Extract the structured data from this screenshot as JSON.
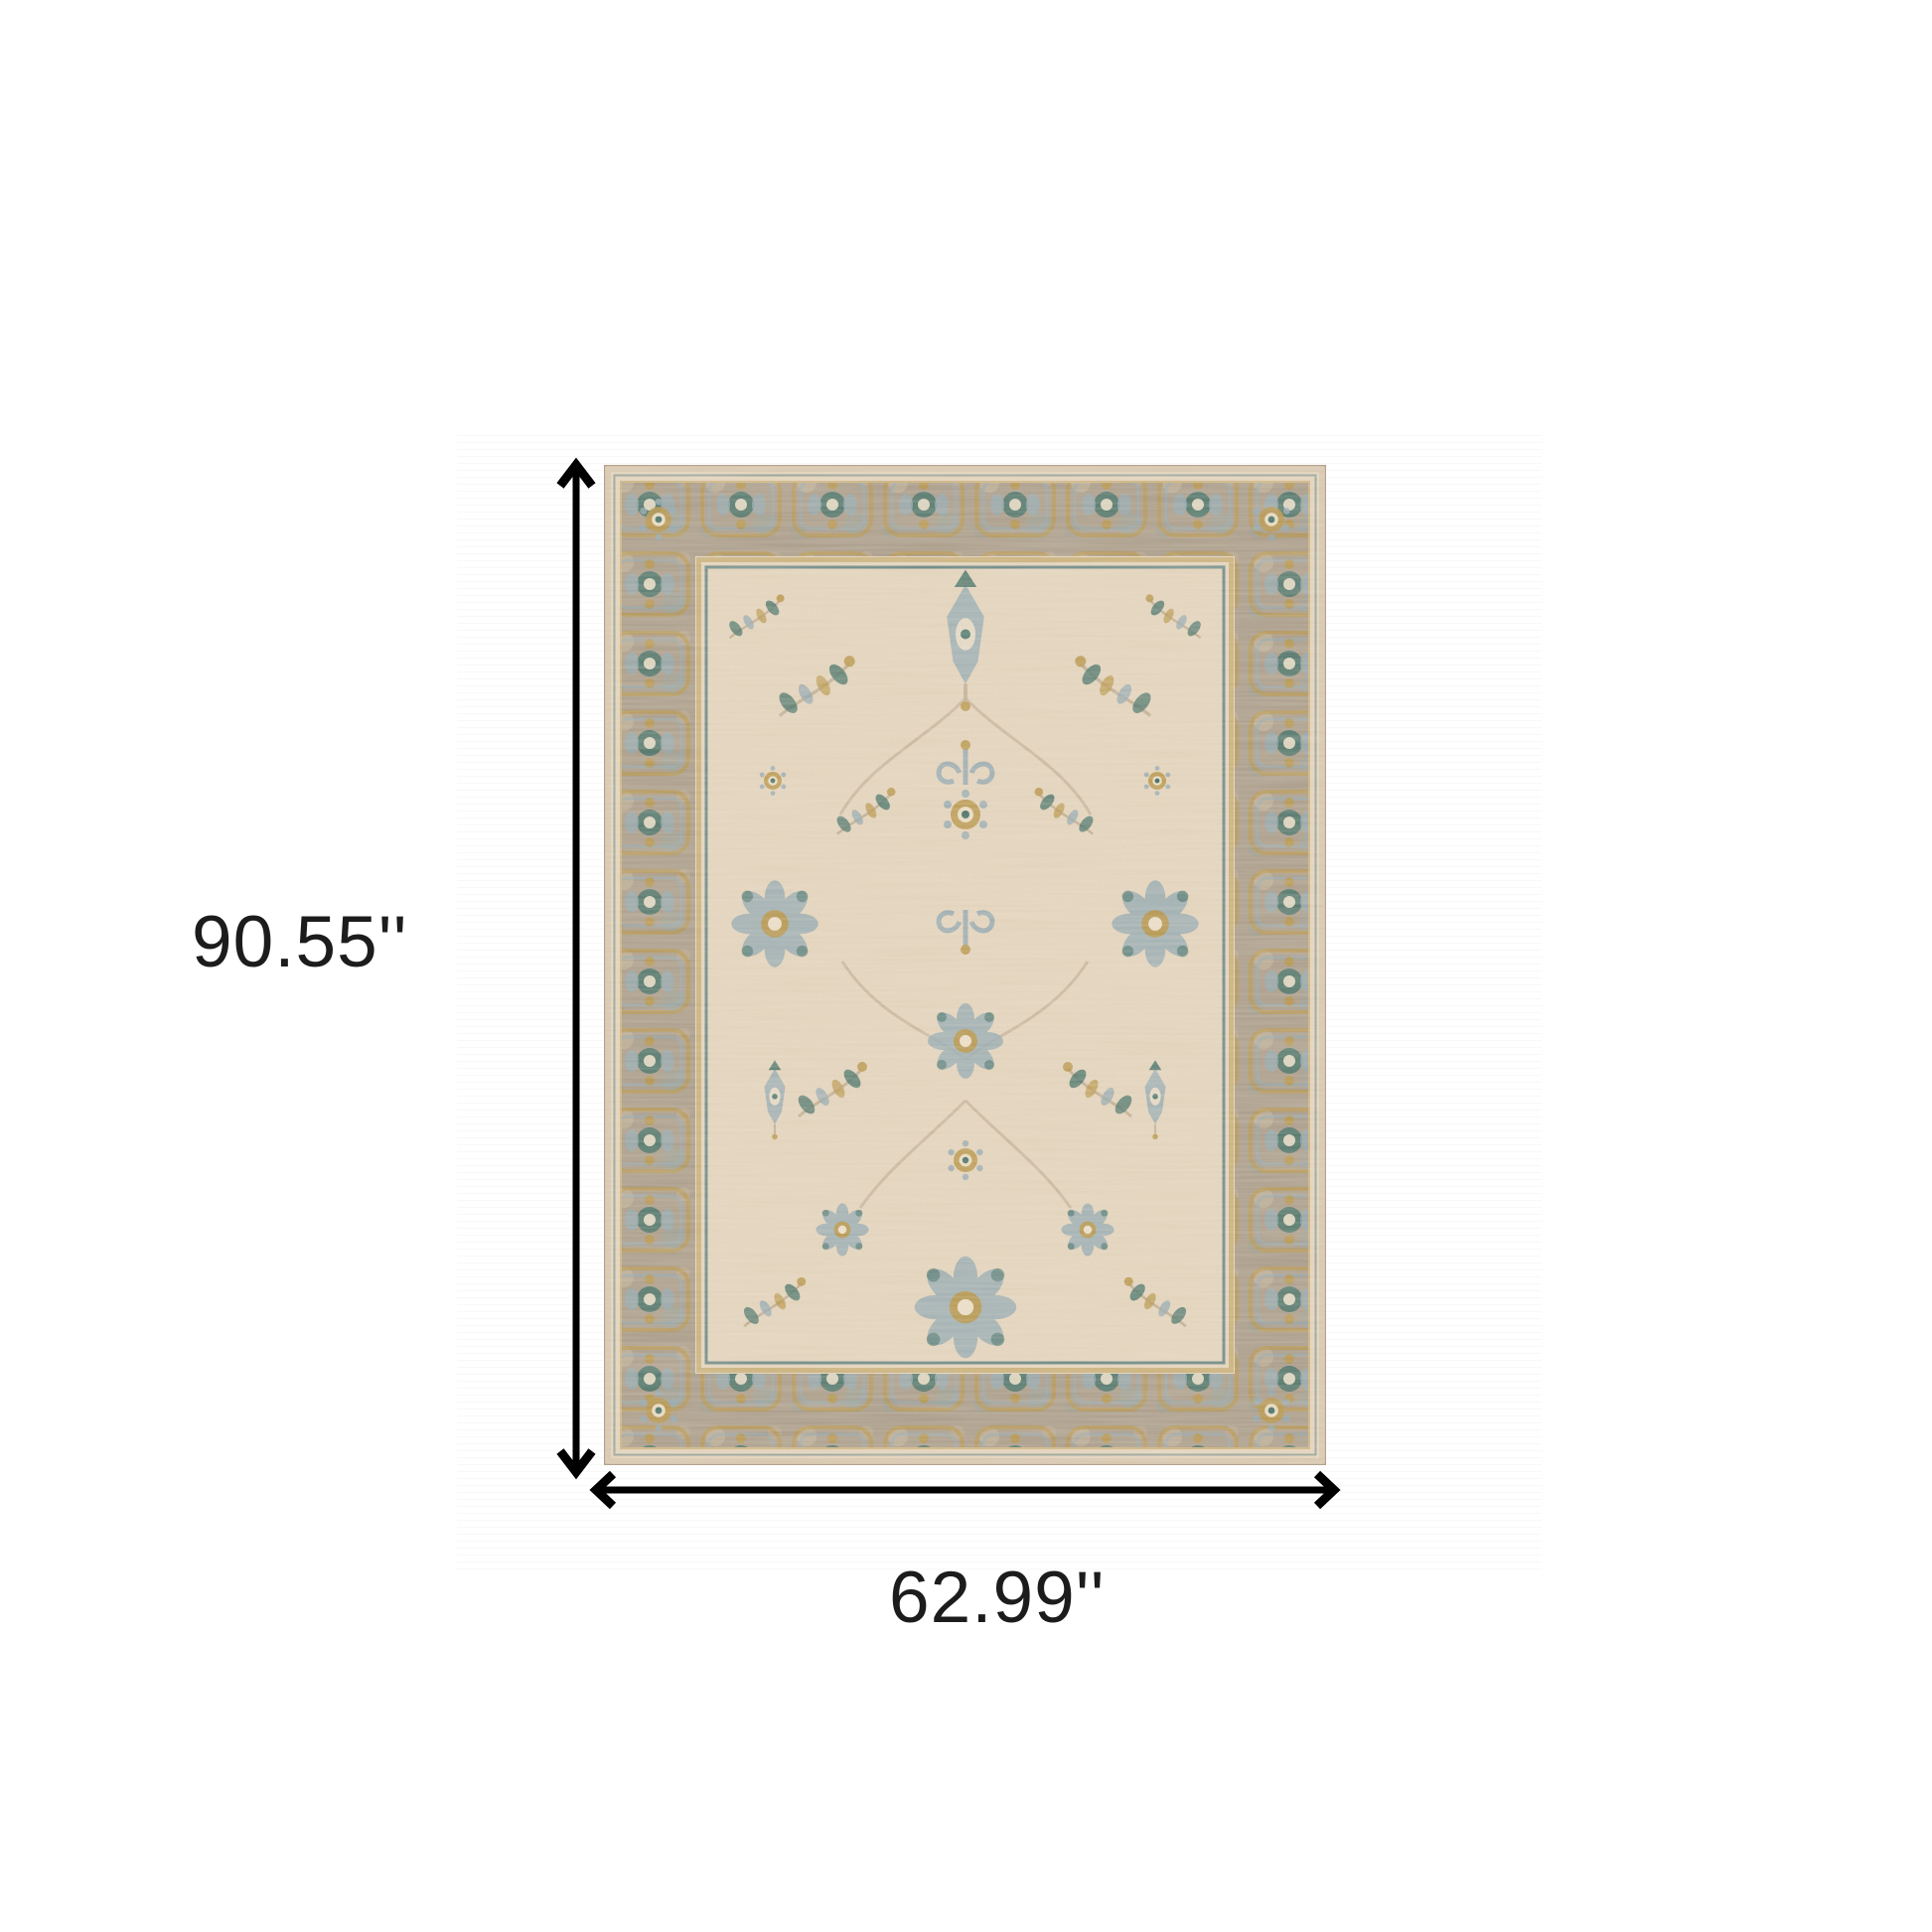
{
  "diagram": {
    "height_label": "90.55''",
    "width_label": "62.99''"
  },
  "colors": {
    "arrow": "#000000",
    "label_text": "#1c1c1c",
    "rug_field": "#e4d4bc",
    "rug_field_streak": "#d2bda2",
    "rug_border_band": "#a89a87",
    "rug_edge": "#d8c7af",
    "accent_teal": "#3c6b62",
    "accent_slate": "#8fa6b0",
    "accent_gold": "#b5913f",
    "guard_line": "#54787a",
    "vine": "#c2ae93",
    "cream": "#ecdfc8",
    "photo_stripe": "#f5f4f1",
    "page_bg": "#ffffff"
  }
}
